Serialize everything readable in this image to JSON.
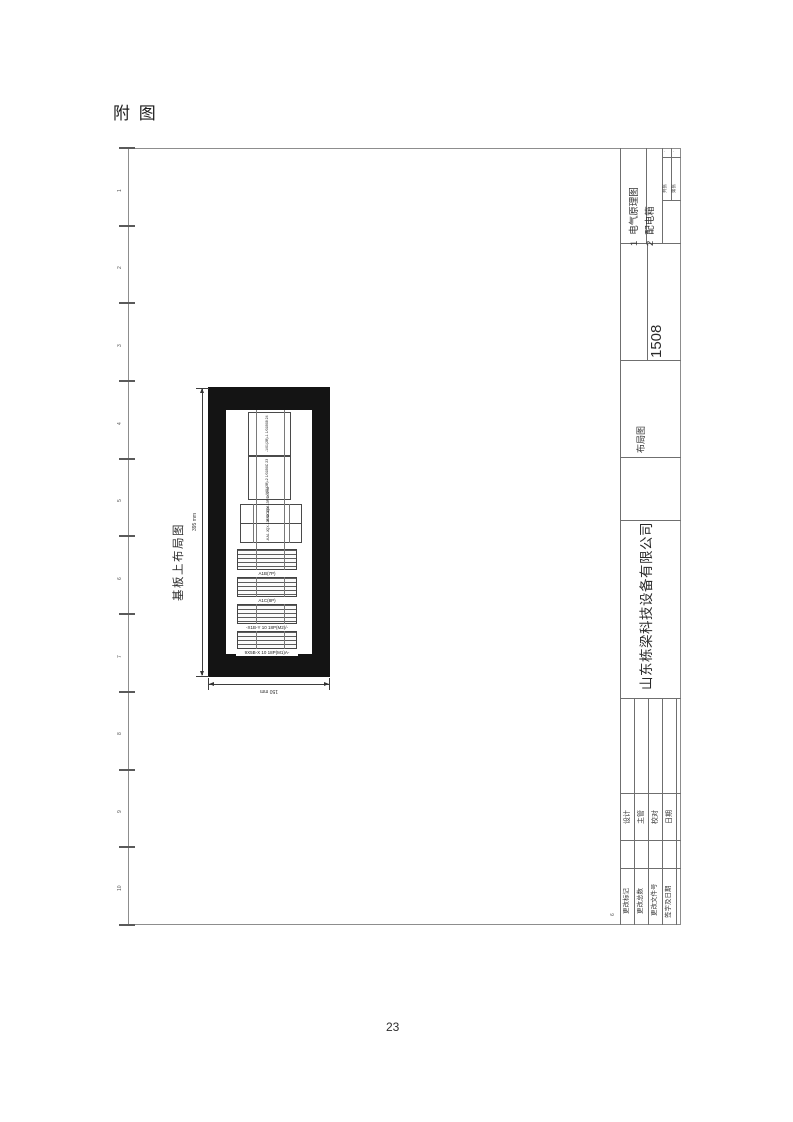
{
  "page": {
    "heading": "附 图",
    "page_number": "23"
  },
  "frame": {
    "zones": [
      "1",
      "2",
      "3",
      "4",
      "5",
      "6",
      "7",
      "8",
      "9",
      "10"
    ],
    "corner_zone": "6"
  },
  "title_block": {
    "doc_list": [
      {
        "no": "1",
        "label": "电气原理图"
      },
      {
        "no": "2",
        "label": "配电箱"
      }
    ],
    "sheet_cells": [
      "共张",
      "第张"
    ],
    "corner_marks": [
      "·",
      "·"
    ],
    "drawing_no": "1508",
    "drawing_title": "布局图",
    "company": "山东栋梁科技设备有限公司",
    "sign_fields": [
      "设计",
      "主管",
      "校对",
      "日期"
    ],
    "change_fields": [
      "更改标记",
      "更改总数",
      "更改文件号",
      "签字及日期"
    ]
  },
  "drawing": {
    "title": "基板上布局图",
    "height_dim": "395 mm",
    "width_dim": "150 mm",
    "components": [
      {
        "type": "box",
        "label": "-1/01(2B)-1 1/01B08 24"
      },
      {
        "type": "box",
        "label": "-1/01(2B)-2 1/01B0C 23"
      },
      {
        "type": "relay",
        "label": "-KA2 JQX-13F/DC24V"
      },
      {
        "type": "relay",
        "label": "-KA1 JQX-13F/DC24V"
      },
      {
        "type": "terminal",
        "label": "A1B(7P)"
      },
      {
        "type": "terminal",
        "label": "A1C(8P)"
      },
      {
        "type": "terminal",
        "label": "-X1B-Y 10 18P(M2)/-"
      },
      {
        "type": "terminal",
        "label": "9X5B-X 10 18P(M1)A-"
      }
    ]
  }
}
